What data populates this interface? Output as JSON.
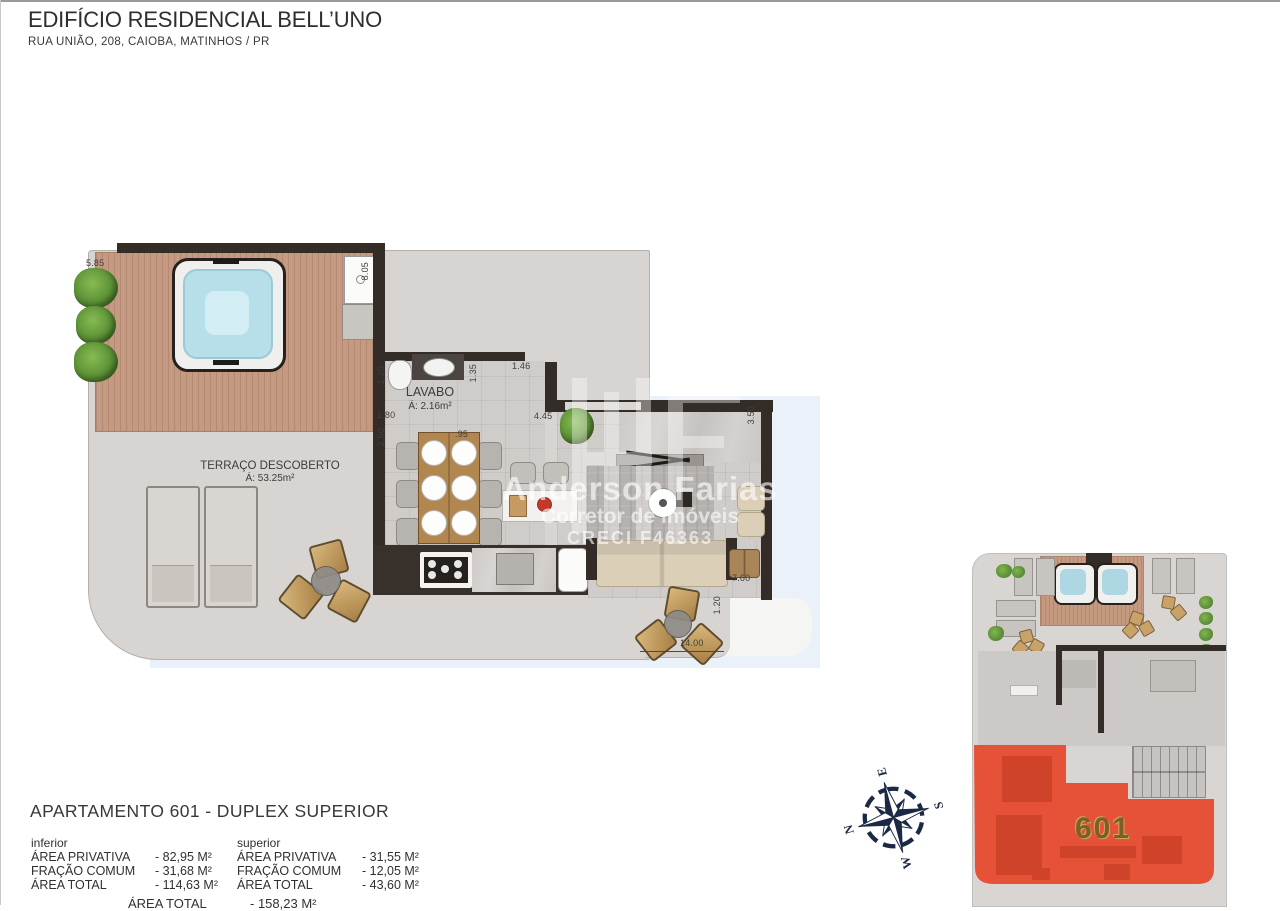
{
  "header": {
    "title": "EDIFÍCIO RESIDENCIAL BELL’UNO",
    "subtitle": "RUA UNIÃO, 208, CAIOBA, MATINHOS / PR"
  },
  "plan": {
    "rooms": {
      "terraco": {
        "name": "TERRAÇO DESCOBERTO",
        "area": "Á: 53.25m²"
      },
      "lavabo": {
        "name": "LAVABO",
        "area": "Á: 2.16m²"
      },
      "living": {
        "name": "LIVING",
        "area": "Á: 27.47m²"
      }
    },
    "dimensions": [
      "5.85",
      "8.05",
      "1.20",
      "1.35",
      "1.46",
      "1.80",
      "2.50",
      ".95",
      "4.45",
      "3.50",
      "7.60",
      "1.20",
      "14.00"
    ]
  },
  "watermark": {
    "line1": "Anderson Farias",
    "line2": "Corretor de Imóveis",
    "line3": "CRECI F46363"
  },
  "info": {
    "heading": "APARTAMENTO 601 - DUPLEX SUPERIOR",
    "columns": [
      {
        "label": "inferior",
        "rows": [
          {
            "name": "ÁREA PRIVATIVA",
            "value": "- 82,95 M²"
          },
          {
            "name": "FRAÇÃO COMUM",
            "value": "- 31,68 M²"
          },
          {
            "name": "ÁREA TOTAL",
            "value": "- 114,63 M²"
          }
        ]
      },
      {
        "label": "superior",
        "rows": [
          {
            "name": "ÁREA PRIVATIVA",
            "value": "- 31,55 M²"
          },
          {
            "name": "FRAÇÃO COMUM",
            "value": "- 12,05 M²"
          },
          {
            "name": "ÁREA TOTAL",
            "value": "- 43,60 M²"
          }
        ]
      }
    ],
    "total": {
      "name": "ÁREA TOTAL",
      "value": "- 158,23 M²"
    }
  },
  "compass": {
    "n": "N",
    "e": "E",
    "s": "S",
    "w": "W"
  },
  "miniplan": {
    "unit_label": "601"
  },
  "colors": {
    "accent_red": "#E6492D",
    "compass_navy": "#1B2944",
    "wall_dark": "#332C27",
    "deck_wood": "#C69A80",
    "water_blue": "#B7DFE9",
    "backdrop_blue": "#EAF1F8",
    "unit_label_brown": "#7C5F27"
  },
  "icons": {
    "compass": "compass-rose-icon",
    "plant": "plant-icon",
    "hot_tub": "hot-tub-icon"
  }
}
